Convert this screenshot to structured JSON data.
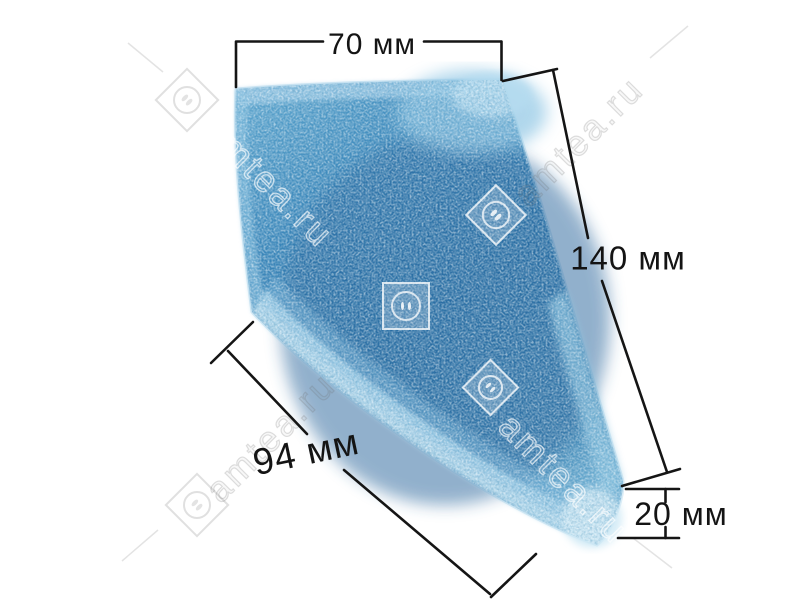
{
  "page": {
    "type": "product-photo",
    "background": "#ffffff",
    "subject": "blue sponge foam filter shown in perspective with measurement callouts"
  },
  "dimensions": {
    "top": {
      "label": "70 мм"
    },
    "right": {
      "label": "140 мм"
    },
    "bottom_left": {
      "label": "94 мм"
    },
    "bottom_right": {
      "label": "20 мм"
    }
  },
  "watermark": {
    "text": "amtea.ru",
    "logo": "diamond-socket-icon"
  },
  "colors": {
    "dimension_line": "#151515",
    "foam_base": "#3781b6",
    "foam_dark": "#26639a",
    "foam_light": "#8fc6e4",
    "foam_edge_highlight": "#b6dbee"
  }
}
